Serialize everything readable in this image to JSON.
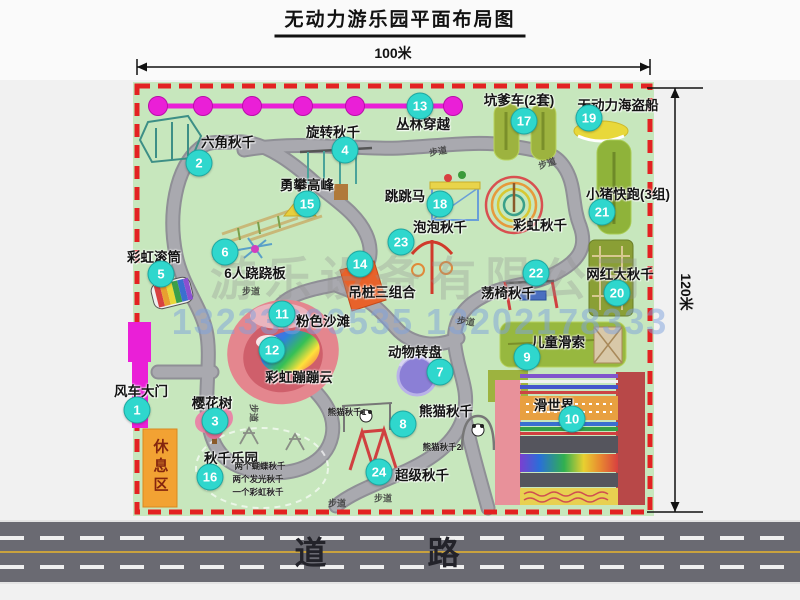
{
  "title": "无动力游乐园平面布局图",
  "dimensions": {
    "width_label": "100米",
    "height_label": "120米"
  },
  "road": {
    "label": "道 路"
  },
  "watermark": {
    "company": "游乐设备有限公司",
    "phone": "13233800535 13202178333"
  },
  "rest_area": {
    "label": "休息区"
  },
  "colors": {
    "park_green": "#c7e7bd",
    "badge_teal": "#2fd7cd",
    "boundary_red": "#e32222",
    "magenta": "#ea1fd7",
    "road_gray": "#6a6a72",
    "rest_orange": "#f2a233"
  },
  "attractions": [
    {
      "num": "1",
      "label": "风车大门",
      "bx": 137,
      "by": 410,
      "lx": 141,
      "ly": 390
    },
    {
      "num": "2",
      "label": "六角秋千",
      "bx": 199,
      "by": 163,
      "lx": 228,
      "ly": 141
    },
    {
      "num": "3",
      "label": "樱花树",
      "bx": 215,
      "by": 421,
      "lx": 212,
      "ly": 402
    },
    {
      "num": "4",
      "label": "旋转秋千",
      "bx": 345,
      "by": 150,
      "lx": 333,
      "ly": 131
    },
    {
      "num": "5",
      "label": "彩虹滚筒",
      "bx": 161,
      "by": 274,
      "lx": 154,
      "ly": 256
    },
    {
      "num": "6",
      "label": "6人跷跷板",
      "bx": 225,
      "by": 252,
      "lx": 255,
      "ly": 272
    },
    {
      "num": "7",
      "label": "动物转盘",
      "bx": 440,
      "by": 372,
      "lx": 415,
      "ly": 351
    },
    {
      "num": "8",
      "label": "熊猫秋千",
      "bx": 403,
      "by": 424,
      "lx": 446,
      "ly": 410
    },
    {
      "num": "9",
      "label": "儿童滑索",
      "bx": 527,
      "by": 357,
      "lx": 558,
      "ly": 341
    },
    {
      "num": "10",
      "label": "滑世界",
      "bx": 572,
      "by": 419,
      "lx": 554,
      "ly": 404
    },
    {
      "num": "11",
      "label": "粉色沙滩",
      "bx": 282,
      "by": 314,
      "lx": 323,
      "ly": 320
    },
    {
      "num": "12",
      "label": "彩虹蹦蹦云",
      "bx": 272,
      "by": 350,
      "lx": 299,
      "ly": 376
    },
    {
      "num": "13",
      "label": "丛林穿越",
      "bx": 420,
      "by": 106,
      "lx": 423,
      "ly": 123
    },
    {
      "num": "14",
      "label": "吊桩三组合",
      "bx": 360,
      "by": 264,
      "lx": 382,
      "ly": 291
    },
    {
      "num": "15",
      "label": "勇攀高峰",
      "bx": 307,
      "by": 204,
      "lx": 307,
      "ly": 184
    },
    {
      "num": "16",
      "label": "秋千乐园",
      "bx": 210,
      "by": 477,
      "lx": 231,
      "ly": 457
    },
    {
      "num": "17",
      "label": "坑爹车(2套)",
      "bx": 524,
      "by": 121,
      "lx": 519,
      "ly": 99
    },
    {
      "num": "18",
      "label": "跳跳马",
      "bx": 440,
      "by": 204,
      "lx": 405,
      "ly": 195
    },
    {
      "num": "19",
      "label": "无动力海盗船",
      "bx": 589,
      "by": 118,
      "lx": 618,
      "ly": 104
    },
    {
      "num": "20",
      "label": "网红大秋千",
      "bx": 617,
      "by": 293,
      "lx": 620,
      "ly": 273
    },
    {
      "num": "21",
      "label": "小猪快跑(3组)",
      "bx": 602,
      "by": 212,
      "lx": 628,
      "ly": 193
    },
    {
      "num": "22",
      "label": "荡椅秋千",
      "bx": 536,
      "by": 273,
      "lx": 508,
      "ly": 292
    },
    {
      "num": "23",
      "label": "泡泡秋千",
      "bx": 401,
      "by": 242,
      "lx": 440,
      "ly": 226
    },
    {
      "num": "24",
      "label": "超级秋千",
      "bx": 379,
      "by": 472,
      "lx": 422,
      "ly": 474
    }
  ],
  "extra_labels": [
    {
      "text": "彩虹秋千",
      "x": 540,
      "y": 224,
      "size": 13.5,
      "bold": true
    },
    {
      "text": "熊猫秋千1",
      "x": 347,
      "y": 412,
      "size": 8.5,
      "bold": true
    },
    {
      "text": "熊猫秋千2",
      "x": 442,
      "y": 447,
      "size": 8.5,
      "bold": true
    },
    {
      "text": "两个蝴蝶秋千",
      "x": 260,
      "y": 466,
      "size": 8.5,
      "bold": true
    },
    {
      "text": "两个发光秋千",
      "x": 258,
      "y": 479,
      "size": 8.5,
      "bold": true
    },
    {
      "text": "一个彩虹秋千",
      "x": 258,
      "y": 492,
      "size": 8.5,
      "bold": true
    }
  ],
  "path_labels": [
    {
      "text": "步道",
      "x": 438,
      "y": 151,
      "rot": -10
    },
    {
      "text": "步道",
      "x": 547,
      "y": 163,
      "rot": -18
    },
    {
      "text": "步道",
      "x": 251,
      "y": 291,
      "rot": 0
    },
    {
      "text": "步道",
      "x": 254,
      "y": 413,
      "rot": 90
    },
    {
      "text": "步道",
      "x": 466,
      "y": 321,
      "rot": 8
    },
    {
      "text": "步道",
      "x": 337,
      "y": 503,
      "rot": 0
    },
    {
      "text": "步道",
      "x": 383,
      "y": 498,
      "rot": 0
    }
  ]
}
